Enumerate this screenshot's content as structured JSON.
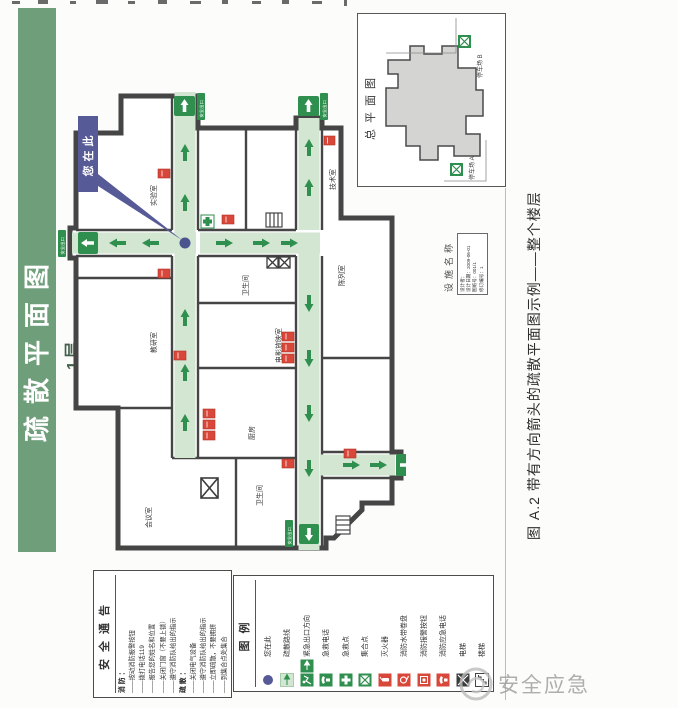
{
  "banner": {
    "title": "疏散平面图",
    "floor_label": "1层"
  },
  "plan": {
    "you_are_here": "您在此",
    "exit_sign": "安全出口",
    "rooms": [
      "实验室",
      "教研室",
      "会议室",
      "厨房",
      "电影放映室",
      "陈列室",
      "技术室",
      "卫生间",
      "卫生间"
    ]
  },
  "inset": {
    "title": "总平面图",
    "parking_a": "停车场 A",
    "parking_b": "停车场 B"
  },
  "facility": {
    "label": "设施名称",
    "lines": [
      "设计者：",
      "设计日期：2009-06-01",
      "图纸号：001/1",
      "修订编号：1"
    ]
  },
  "caption": "图 A.2  带有方向箭头的疏散平面图示例——整个楼层",
  "notice": {
    "title": "安全通告",
    "fire_heading": "消防：",
    "fire_items": [
      "——按动消防报警按钮",
      "——拨打电话119",
      "——报告您的姓名和位置",
      "——关闭门窗（不要上锁）",
      "——遵守消防队给出的指示"
    ],
    "evac_heading": "疏散：",
    "evac_items": [
      "——关闭电气设备",
      "——遵守消防队给出的指示",
      "——立即疏散，不要拥挤",
      "——到集合点处集合"
    ]
  },
  "legend": {
    "title": "图例",
    "items": [
      {
        "label": "您在此",
        "icon": "you-are-here-dot-icon"
      },
      {
        "label": "疏散路线",
        "icon": "escape-route-arrow-icon"
      },
      {
        "label": "紧急出口方向",
        "icon": "emergency-exit-direction-icon"
      },
      {
        "label": "急救电话",
        "icon": "first-aid-phone-icon"
      },
      {
        "label": "急救点",
        "icon": "first-aid-point-icon"
      },
      {
        "label": "集合点",
        "icon": "assembly-point-icon"
      },
      {
        "label": "灭火器",
        "icon": "fire-extinguisher-icon"
      },
      {
        "label": "消防水带卷盘",
        "icon": "fire-hose-reel-icon"
      },
      {
        "label": "消防报警按钮",
        "icon": "fire-alarm-button-icon"
      },
      {
        "label": "消防应急电话",
        "icon": "fire-emergency-phone-icon"
      },
      {
        "label": "电梯",
        "icon": "elevator-icon"
      },
      {
        "label": "楼梯",
        "icon": "stairs-icon"
      }
    ]
  },
  "watermark": "安全应急",
  "colors": {
    "banner_green": "#6f9e7a",
    "route_green": "#d3e6d1",
    "sign_green": "#2f8f4e",
    "alarm_red": "#d9473a",
    "marker_indigo": "#565a96",
    "wall_gray": "#454545"
  }
}
